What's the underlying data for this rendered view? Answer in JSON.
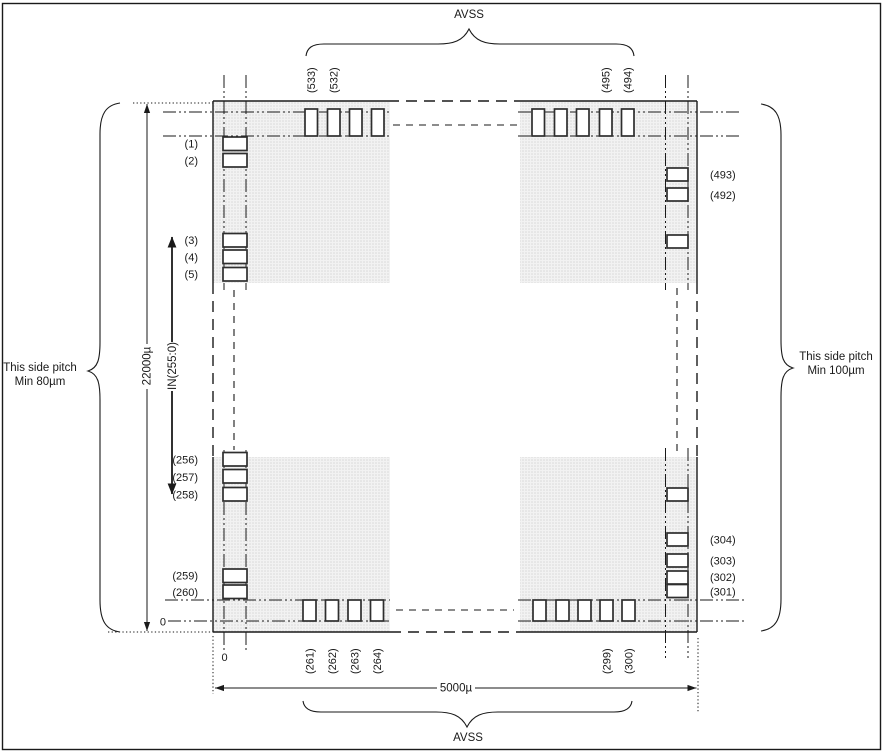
{
  "diagram": {
    "top_bus_label": "AVSS",
    "bottom_bus_label": "AVSS",
    "left_pitch": {
      "line1": "This side pitch",
      "line2": "Min 80µm"
    },
    "right_pitch": {
      "line1": "This side pitch",
      "line2": "Min 100µm"
    },
    "dimensions": {
      "height": "22000µ",
      "width": "5000µ"
    },
    "bus_range_label": "IN(255:0)",
    "origin_left": "0",
    "origin_bottom": "0",
    "pins": {
      "left_top": [
        "(1)",
        "(2)",
        "(3)",
        "(4)",
        "(5)"
      ],
      "left_bottom": [
        "(256)",
        "(257)",
        "(258)",
        "(259)",
        "(260)"
      ],
      "right_top": [
        "(493)",
        "(492)"
      ],
      "right_bottom": [
        "(304)",
        "(303)",
        "(302)",
        "(301)"
      ],
      "top_left_group": [
        "(533)",
        "(532)"
      ],
      "top_right_group": [
        "(495)",
        "(494)"
      ],
      "bottom_left_group": [
        "(261)",
        "(262)",
        "(263)",
        "(264)"
      ],
      "bottom_right_group": [
        "(299)",
        "(300)"
      ]
    },
    "colors": {
      "background": "#ffffff",
      "line": "#1a1a1a",
      "pad_fill": "#ffffff",
      "pad_stroke": "#2e2e2e",
      "shade_base": "#f2f2f2",
      "shade_dot": "#d7d7d7"
    }
  }
}
